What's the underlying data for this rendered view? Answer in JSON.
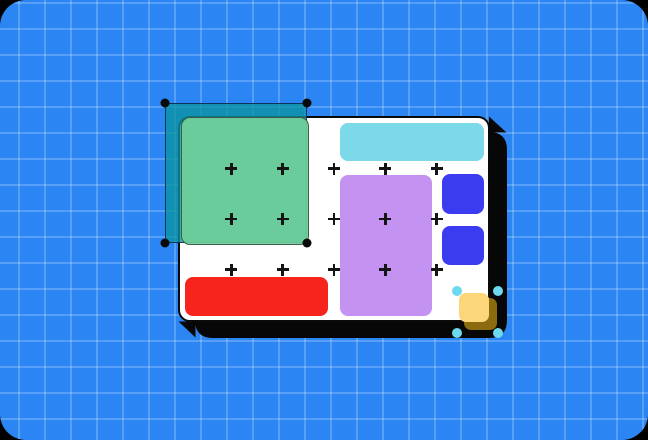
{
  "scene": {
    "type": "design-canvas-illustration",
    "colors": {
      "page_background": "#000000",
      "canvas_blue": "#2b86f4",
      "artboard_white": "#ffffff",
      "artboard_border_black": "#0a0a0a",
      "shadow_black": "#070707",
      "selection_overlay_teal": "rgba(10,148,160,0.78)",
      "selection_border_navy": "rgba(13,42,84,0.9)",
      "green_shape": "rgba(108,206,152,0.92)",
      "selection_handle_black": "#0a0a0a",
      "cyan_bar": "#7cd9e9",
      "purple_rectangle": "#c492f1",
      "blue_square": "#3b3cf0",
      "red_bar": "#f6241d",
      "yellow_square": "#fcd77a",
      "gold_square": "#8a6c0e",
      "resize_handle_cyan": "#6ed8ee",
      "plus_marker": "#141414"
    },
    "artboard": {
      "plus_grid": {
        "cols": 5,
        "rows": 3
      }
    },
    "shapes": [
      {
        "name": "green-rectangle",
        "color": "green_shape",
        "state": "selected-with-marquee"
      },
      {
        "name": "cyan-bar",
        "color": "cyan_bar"
      },
      {
        "name": "purple-rectangle",
        "color": "purple_rectangle"
      },
      {
        "name": "blue-square-1",
        "color": "blue_square"
      },
      {
        "name": "blue-square-2",
        "color": "blue_square"
      },
      {
        "name": "red-bar",
        "color": "red_bar"
      },
      {
        "name": "yellow-square",
        "color": "yellow_square",
        "state": "resizing-with-handles"
      },
      {
        "name": "gold-square",
        "color": "gold_square"
      }
    ]
  }
}
